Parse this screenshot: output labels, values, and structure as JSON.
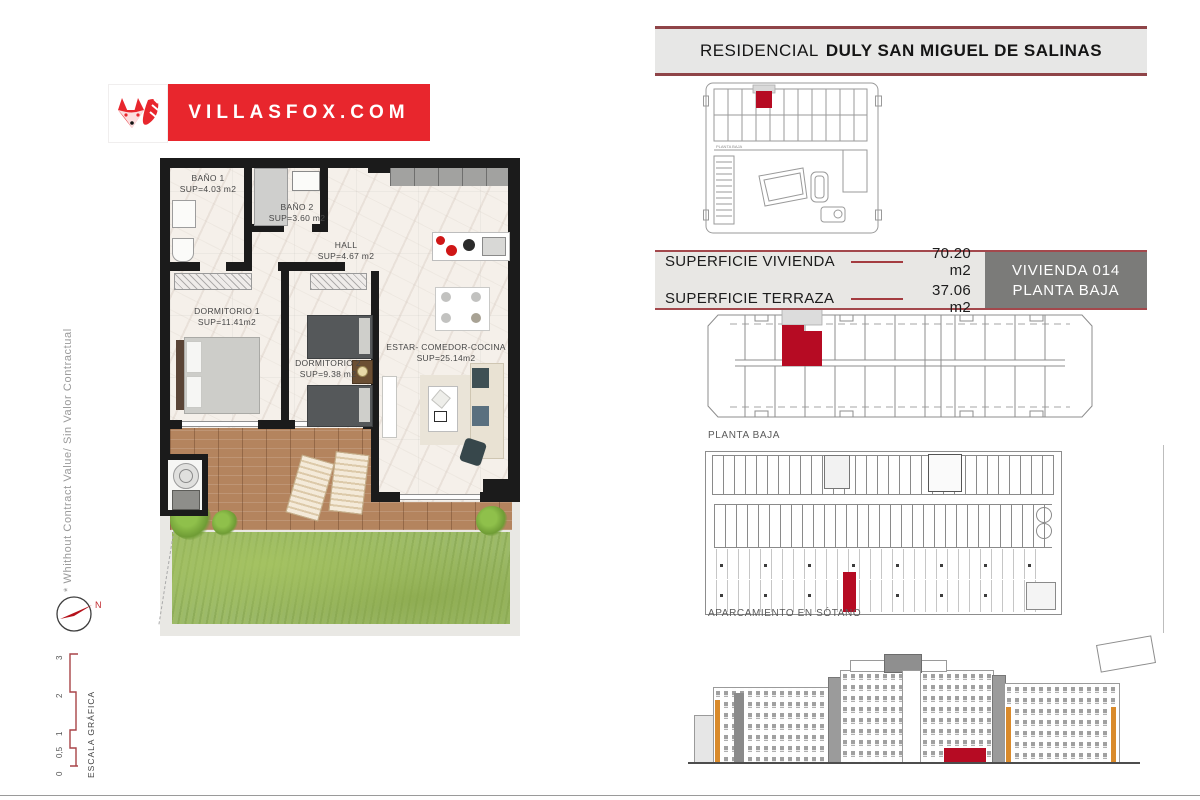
{
  "header": {
    "banner_prefix": "RESIDENCIAL",
    "banner_title": "DULY SAN MIGUEL DE SALINAS"
  },
  "logo": {
    "domain": "VILLASFOX.COM"
  },
  "info_panel": {
    "rows": [
      {
        "label": "SUPERFICIE VIVIENDA",
        "value": "70.20 m2"
      },
      {
        "label": "SUPERFICIE TERRAZA",
        "value": "37.06 m2"
      }
    ],
    "unit_box": {
      "line1": "VIVIENDA 014",
      "line2": "PLANTA BAJA"
    }
  },
  "floorplan": {
    "rooms": [
      {
        "name": "BAÑO 1",
        "area": "SUP=4.03 m2"
      },
      {
        "name": "BAÑO 2",
        "area": "SUP=3.60 m2"
      },
      {
        "name": "HALL",
        "area": "SUP=4.67 m2"
      },
      {
        "name": "DORMITORIO 1",
        "area": "SUP=11.41m2"
      },
      {
        "name": "DORMITORIO 2",
        "area": "SUP=9.38 m2"
      },
      {
        "name": "ESTAR- COMEDOR-COCINA",
        "area": "SUP=25.14m2"
      }
    ]
  },
  "diagrams": {
    "site_overview_label": "PLANTA BAJA",
    "floor_plan_label": "PLANTA BAJA",
    "parking_label": "APARCAMIENTO EN SÓTANO"
  },
  "annotations": {
    "disclaimer": "* Whithout Contract Value/ Sin Valor Contractual",
    "compass_north": "N",
    "scale_bar": {
      "label": "ESCALA GRÁFICA",
      "ticks": [
        "0",
        "0,5",
        "1",
        "2",
        "3"
      ]
    }
  },
  "colors": {
    "accent_red": "#b60b23",
    "logo_red": "#e8262d",
    "banner_border": "#8f4448",
    "unit_box_grey": "#7b7b79"
  }
}
